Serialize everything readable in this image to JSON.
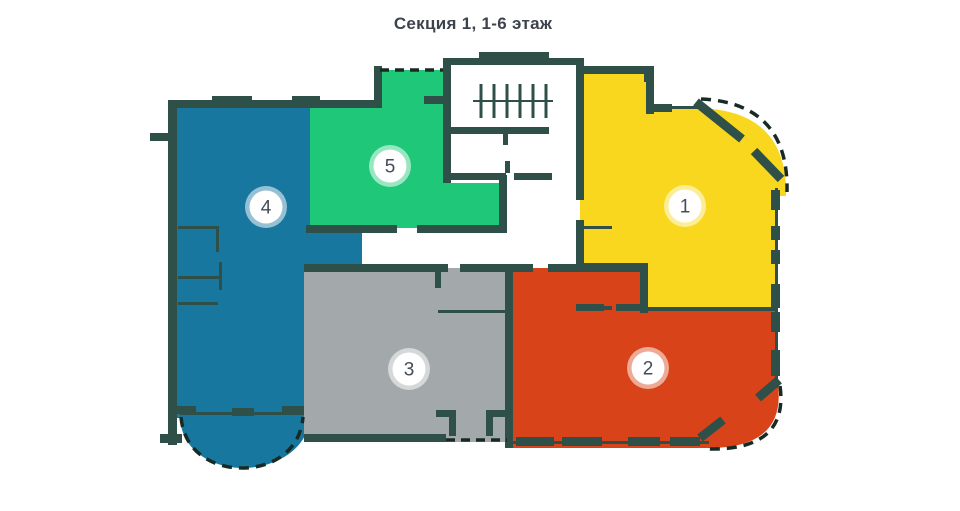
{
  "title": "Секция 1, 1-6 этаж",
  "units": [
    {
      "number": "1",
      "color": "#f8d71e"
    },
    {
      "number": "2",
      "color": "#d8431a"
    },
    {
      "number": "3",
      "color": "#a3a8ab"
    },
    {
      "number": "4",
      "color": "#17779f"
    },
    {
      "number": "5",
      "color": "#1ec878"
    }
  ],
  "colors": {
    "wall": "#2f4f49",
    "outline": "#182a24",
    "badge_fill": "#ffffff",
    "badge_text": "#434c57",
    "title_text": "#3d434b",
    "background": "#ffffff"
  }
}
